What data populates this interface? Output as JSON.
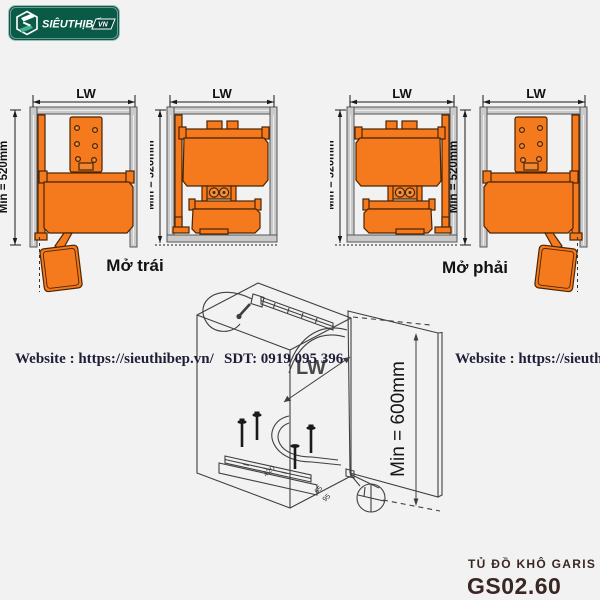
{
  "colors": {
    "background": "#f2f2f2",
    "accent_orange": "#f5791d",
    "outline_brown": "#4a2504",
    "frame_gray": "#cacaca",
    "drawing_line": "#3f3f3f",
    "logo_green": "#0a5a48",
    "title_maroon": "#3a2723",
    "watermark_ink": "#1e1e38"
  },
  "logo": {
    "brand": "SIÊUTHỊBẾP",
    "tld": "VN"
  },
  "diagrams": {
    "width_label": "LW",
    "height_label": "Min = 520mm",
    "captions": {
      "left": "Mở trái",
      "right": "Mở phải"
    }
  },
  "isometric": {
    "width_label": "LW",
    "door_height_label": "Min = 600mm",
    "rail_dim": "420",
    "dim_a": "65",
    "dim_b": "95"
  },
  "watermarks": {
    "site_left": "Website : https://sieuthibep.vn/",
    "phone": "SDT: 0919 095 396",
    "site_right": "Website : https://sieuthib"
  },
  "product": {
    "name": "TỦ ĐỒ KHÔ GARIS",
    "model": "GS02.60"
  }
}
